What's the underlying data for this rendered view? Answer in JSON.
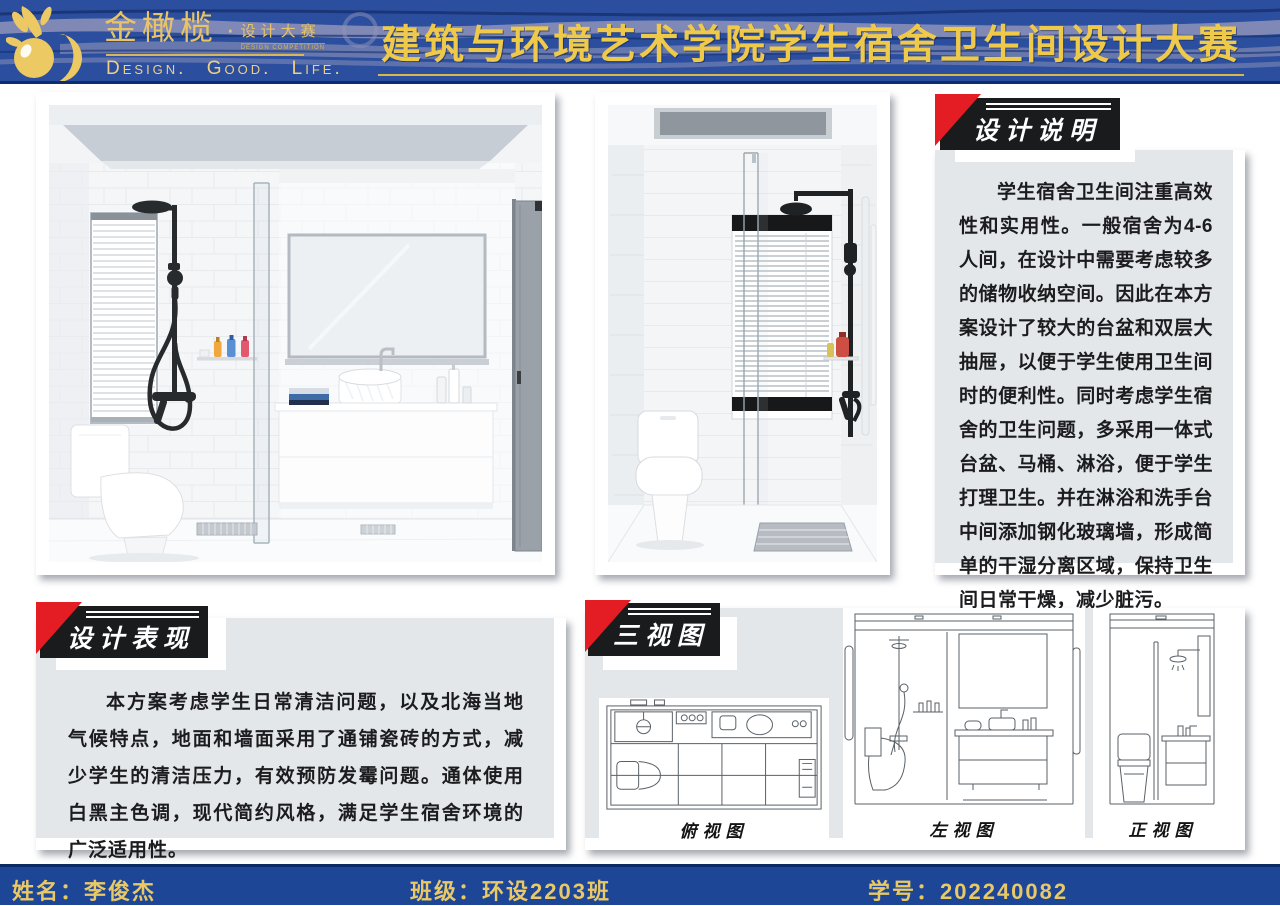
{
  "header": {
    "logo": {
      "brand": "金橄榄",
      "dot": "·",
      "sub_brand": "设计大赛",
      "sub_brand_en": "DESIGN COMPETITION",
      "tagline": "Design. Good. Life."
    },
    "title": "建筑与环境艺术学院学生宿舍卫生间设计大赛"
  },
  "panels": {
    "design_description": {
      "title": "设计说明",
      "body": "学生宿舍卫生间注重高效性和实用性。一般宿舍为4-6人间，在设计中需要考虑较多的储物收纳空间。因此在本方案设计了较大的台盆和双层大抽屉，以便于学生使用卫生间时的便利性。同时考虑学生宿舍的卫生问题，多采用一体式台盆、马桶、淋浴，便于学生打理卫生。并在淋浴和洗手台中间添加钢化玻璃墙，形成简单的干湿分离区域，保持卫生间日常干燥，减少脏污。"
    },
    "design_expression": {
      "title": "设计表现",
      "body": "本方案考虑学生日常清洁问题，以及北海当地气候特点，地面和墙面采用了通铺瓷砖的方式，减少学生的清洁压力，有效预防发霉问题。通体使用白黑主色调，现代简约风格，满足学生宿舍环境的广泛适用性。"
    },
    "three_views": {
      "title": "三视图",
      "views": [
        {
          "label": "俯视图"
        },
        {
          "label": "左视图"
        },
        {
          "label": "正视图"
        }
      ]
    }
  },
  "footer": {
    "name": "姓名：李俊杰",
    "class": "班级：环设2203班",
    "student_id": "学号：202240082"
  },
  "colors": {
    "header_blue": "#2B4E9E",
    "footer_blue": "#1D4697",
    "navy_line": "#0C2E6E",
    "gold": "#EFC94A",
    "logo_gold": "#E8C466",
    "panel_gray": "#E3E7EA",
    "title_box_black": "#1A1B1D",
    "corner_red": "#E41C23",
    "fixture_black": "#282B2D",
    "bottle_orange": "#F0A73E",
    "bottle_blue": "#5B8FD4",
    "bottle_red": "#E2586D",
    "shampoo_red": "#CD4F43"
  }
}
